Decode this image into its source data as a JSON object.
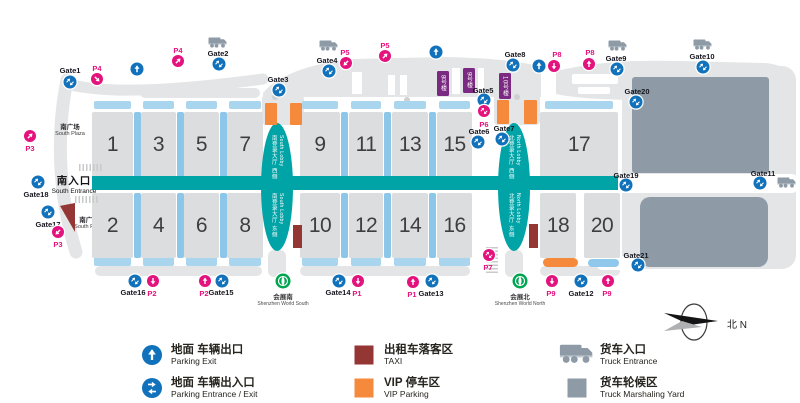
{
  "colors": {
    "pink": "#E4127D",
    "blue": "#1172BB",
    "teal": "#00A4A7",
    "bar_h": "#A9D5EE",
    "bar_v": "#8CC6E9",
    "hall": "#DCDDDE",
    "base_gray": "#E4E5E6",
    "yard": "#8E9BA7",
    "orange": "#F58A3C",
    "taxi": "#943634",
    "purple": "#7B2A82",
    "metro_green": "#00A551",
    "pill_blue": "#8FC8EA"
  },
  "map": {
    "south_plaza_top": {
      "zh": "南广场",
      "en": "South Plaza"
    },
    "south_entrance": {
      "zh": "南入口",
      "en": "South Entrance"
    },
    "south_plaza_mid": {
      "zh": "南广场",
      "en": "South Plaza"
    },
    "compass": {
      "zh": "北",
      "en": "N"
    },
    "corridor": {
      "x": 92,
      "y": 176,
      "w": 526,
      "h": 14
    },
    "halls": [
      {
        "n": "1",
        "x": 92,
        "y": 112,
        "w": 41,
        "h": 65
      },
      {
        "n": "3",
        "x": 141,
        "y": 112,
        "w": 35,
        "h": 65
      },
      {
        "n": "5",
        "x": 184,
        "y": 112,
        "w": 35,
        "h": 65
      },
      {
        "n": "7",
        "x": 227,
        "y": 112,
        "w": 36,
        "h": 65
      },
      {
        "n": "9",
        "x": 300,
        "y": 112,
        "w": 40,
        "h": 65
      },
      {
        "n": "11",
        "x": 349,
        "y": 112,
        "w": 34,
        "h": 65
      },
      {
        "n": "13",
        "x": 392,
        "y": 112,
        "w": 36,
        "h": 65
      },
      {
        "n": "15",
        "x": 437,
        "y": 112,
        "w": 35,
        "h": 65
      },
      {
        "n": "17",
        "x": 540,
        "y": 112,
        "w": 78,
        "h": 65
      },
      {
        "n": "2",
        "x": 92,
        "y": 193,
        "w": 41,
        "h": 65
      },
      {
        "n": "4",
        "x": 141,
        "y": 193,
        "w": 35,
        "h": 65
      },
      {
        "n": "6",
        "x": 184,
        "y": 193,
        "w": 35,
        "h": 65
      },
      {
        "n": "8",
        "x": 227,
        "y": 193,
        "w": 36,
        "h": 65
      },
      {
        "n": "10",
        "x": 300,
        "y": 193,
        "w": 40,
        "h": 65
      },
      {
        "n": "12",
        "x": 349,
        "y": 193,
        "w": 34,
        "h": 65
      },
      {
        "n": "14",
        "x": 392,
        "y": 193,
        "w": 36,
        "h": 65
      },
      {
        "n": "16",
        "x": 437,
        "y": 193,
        "w": 35,
        "h": 65
      },
      {
        "n": "18",
        "x": 540,
        "y": 193,
        "w": 36,
        "h": 65
      },
      {
        "n": "20",
        "x": 584,
        "y": 193,
        "w": 36,
        "h": 65
      }
    ],
    "gates": [
      {
        "label": "Gate1",
        "x": 70,
        "y": 82,
        "lx": 70,
        "ly": 70
      },
      {
        "label": "Gate2",
        "x": 219,
        "y": 64,
        "lx": 218,
        "ly": 53,
        "truck": {
          "x": 218,
          "y": 42
        }
      },
      {
        "label": "Gate3",
        "x": 279,
        "y": 90,
        "lx": 278,
        "ly": 79
      },
      {
        "label": "Gate4",
        "x": 329,
        "y": 71,
        "lx": 327,
        "ly": 60,
        "truck": {
          "x": 329,
          "y": 45
        }
      },
      {
        "label": "Gate5",
        "x": 484,
        "y": 100,
        "lx": 483,
        "ly": 90
      },
      {
        "label": "Gate6",
        "x": 478,
        "y": 142,
        "lx": 479,
        "ly": 131
      },
      {
        "label": "Gate7",
        "x": 502,
        "y": 139,
        "lx": 504,
        "ly": 128
      },
      {
        "label": "Gate8",
        "x": 513,
        "y": 65,
        "lx": 515,
        "ly": 54
      },
      {
        "label": "Gate9",
        "x": 617,
        "y": 69,
        "lx": 616,
        "ly": 58,
        "truck": {
          "x": 618,
          "y": 45
        }
      },
      {
        "label": "Gate10",
        "x": 703,
        "y": 67,
        "lx": 702,
        "ly": 56,
        "truck": {
          "x": 703,
          "y": 44
        }
      },
      {
        "label": "Gate11",
        "x": 760,
        "y": 183,
        "lx": 763,
        "ly": 173,
        "truck": {
          "x": 787,
          "y": 182
        }
      },
      {
        "label": "Gate12",
        "x": 581,
        "y": 281,
        "lx": 581,
        "ly": 293
      },
      {
        "label": "Gate13",
        "x": 432,
        "y": 281,
        "lx": 431,
        "ly": 293
      },
      {
        "label": "Gate14",
        "x": 339,
        "y": 281,
        "lx": 338,
        "ly": 292
      },
      {
        "label": "Gate15",
        "x": 222,
        "y": 281,
        "lx": 221,
        "ly": 292
      },
      {
        "label": "Gate16",
        "x": 135,
        "y": 281,
        "lx": 133,
        "ly": 292
      },
      {
        "label": "Gate17",
        "x": 48,
        "y": 212,
        "lx": 48,
        "ly": 224
      },
      {
        "label": "Gate18",
        "x": 38,
        "y": 182,
        "lx": 36,
        "ly": 194
      },
      {
        "label": "Gate19",
        "x": 626,
        "y": 185,
        "lx": 626,
        "ly": 175
      },
      {
        "label": "Gate20",
        "x": 636,
        "y": 102,
        "lx": 637,
        "ly": 91
      },
      {
        "label": "Gate21",
        "x": 638,
        "y": 265,
        "lx": 636,
        "ly": 255
      }
    ],
    "parking_markers": [
      {
        "label": "P3",
        "dir": "up-right",
        "x": 30,
        "y": 136,
        "lx": 30,
        "ly": 148
      },
      {
        "label": "P4",
        "dir": "down-right",
        "x": 97,
        "y": 79,
        "lx": 97,
        "ly": 68
      },
      {
        "label": "P4",
        "dir": "up-right",
        "x": 178,
        "y": 61,
        "lx": 178,
        "ly": 50
      },
      {
        "label": "P5",
        "dir": "down-left",
        "x": 346,
        "y": 63,
        "lx": 345,
        "ly": 52
      },
      {
        "label": "P5",
        "dir": "up-right",
        "x": 385,
        "y": 56,
        "lx": 385,
        "ly": 45
      },
      {
        "label": "P8",
        "dir": "down",
        "x": 554,
        "y": 66,
        "lx": 557,
        "ly": 54
      },
      {
        "label": "P8",
        "dir": "up",
        "x": 589,
        "y": 64,
        "lx": 590,
        "ly": 52
      },
      {
        "label": "P6",
        "dir": "dual",
        "x": 484,
        "y": 111,
        "lx": 484,
        "ly": 124
      },
      {
        "label": "P7",
        "dir": "dual",
        "x": 489,
        "y": 255,
        "lx": 488,
        "ly": 267
      },
      {
        "label": "P3",
        "dir": "down-left",
        "x": 58,
        "y": 232,
        "lx": 58,
        "ly": 244
      },
      {
        "label": "P2",
        "dir": "down",
        "x": 153,
        "y": 281,
        "lx": 152,
        "ly": 293
      },
      {
        "label": "P2",
        "dir": "up",
        "x": 205,
        "y": 281,
        "lx": 204,
        "ly": 293
      },
      {
        "label": "P1",
        "dir": "down",
        "x": 358,
        "y": 281,
        "lx": 357,
        "ly": 293
      },
      {
        "label": "P1",
        "dir": "up",
        "x": 413,
        "y": 282,
        "lx": 412,
        "ly": 294
      },
      {
        "label": "P9",
        "dir": "down",
        "x": 552,
        "y": 281,
        "lx": 551,
        "ly": 293
      },
      {
        "label": "P9",
        "dir": "up",
        "x": 608,
        "y": 281,
        "lx": 607,
        "ly": 293
      }
    ],
    "exit_arrows": [
      {
        "x": 137,
        "y": 69
      },
      {
        "x": 436,
        "y": 52
      },
      {
        "x": 539,
        "y": 66
      }
    ],
    "buildings": [
      {
        "label": "8号楼",
        "x": 437,
        "y": 71,
        "w": 12,
        "h": 25
      },
      {
        "label": "9号楼",
        "x": 463,
        "y": 68,
        "w": 12,
        "h": 25
      },
      {
        "label": "10号楼",
        "x": 499,
        "y": 73,
        "w": 12,
        "h": 26
      }
    ],
    "lobbies": [
      {
        "x": 261,
        "y": 123,
        "w": 32,
        "h": 128,
        "upper_zh": "南登录大厅 西侧",
        "upper_en": "South Lobby",
        "lower_zh": "南登录大厅 东侧",
        "lower_en": "South Lobby"
      },
      {
        "x": 498,
        "y": 123,
        "w": 32,
        "h": 128,
        "upper_zh": "北登录大厅 西侧",
        "upper_en": "North Lobby",
        "lower_zh": "北登录大厅 东侧",
        "lower_en": "North Lobby"
      }
    ],
    "metro_stations": [
      {
        "x": 283,
        "y": 281,
        "zh": "会展南",
        "en": "Shenzhen World South"
      },
      {
        "x": 520,
        "y": 281,
        "zh": "会展北",
        "en": "Shenzhen World North"
      }
    ],
    "taxi_zones": [
      {
        "x": 60,
        "y": 203,
        "w": 15,
        "h": 29,
        "shape": "wedge"
      },
      {
        "x": 293,
        "y": 225,
        "w": 9,
        "h": 23,
        "shape": "rect"
      },
      {
        "x": 529,
        "y": 224,
        "w": 9,
        "h": 24,
        "shape": "rect"
      }
    ],
    "vip_zones": [
      {
        "x": 265,
        "y": 103,
        "w": 12,
        "h": 22,
        "r": 1
      },
      {
        "x": 290,
        "y": 103,
        "w": 12,
        "h": 22,
        "r": 1
      },
      {
        "x": 497,
        "y": 100,
        "w": 12,
        "h": 24,
        "r": 1
      },
      {
        "x": 524,
        "y": 100,
        "w": 13,
        "h": 24,
        "r": 1
      },
      {
        "x": 543,
        "y": 258,
        "w": 35,
        "h": 9,
        "r": 4.5
      }
    ],
    "blue_pills": [
      {
        "x": 588,
        "y": 259,
        "w": 31,
        "h": 8,
        "r": 4
      }
    ],
    "hatches": [
      {
        "x": 79,
        "y": 164,
        "w": 24,
        "h": 7,
        "v": false
      },
      {
        "x": 75,
        "y": 196,
        "w": 24,
        "h": 7,
        "v": false
      },
      {
        "x": 486,
        "y": 247,
        "w": 12,
        "h": 26,
        "v": true
      }
    ]
  },
  "legend": {
    "items": [
      {
        "icon": "exit",
        "zh": "地面 车辆出口",
        "en": "Parking Exit",
        "x": 152,
        "y": 355,
        "tx": 171,
        "ty": 344
      },
      {
        "icon": "dual-h",
        "zh": "地面 车辆出入口",
        "en": "Parking Entrance / Exit",
        "x": 152,
        "y": 388,
        "tx": 171,
        "ty": 377
      },
      {
        "icon": "taxi-square",
        "zh": "出租车落客区",
        "en": "TAXI",
        "x": 364,
        "y": 355,
        "tx": 384,
        "ty": 344
      },
      {
        "icon": "vip-square",
        "zh": "VIP 停车区",
        "en": "VIP Parking",
        "x": 364,
        "y": 388,
        "tx": 384,
        "ty": 377
      },
      {
        "icon": "truck",
        "zh": "货车入口",
        "en": "Truck Entrance",
        "x": 577,
        "y": 354,
        "tx": 600,
        "ty": 344
      },
      {
        "icon": "yard-square",
        "zh": "货车轮候区",
        "en": "Truck Marshaling Yard",
        "x": 577,
        "y": 388,
        "tx": 600,
        "ty": 377
      }
    ]
  }
}
